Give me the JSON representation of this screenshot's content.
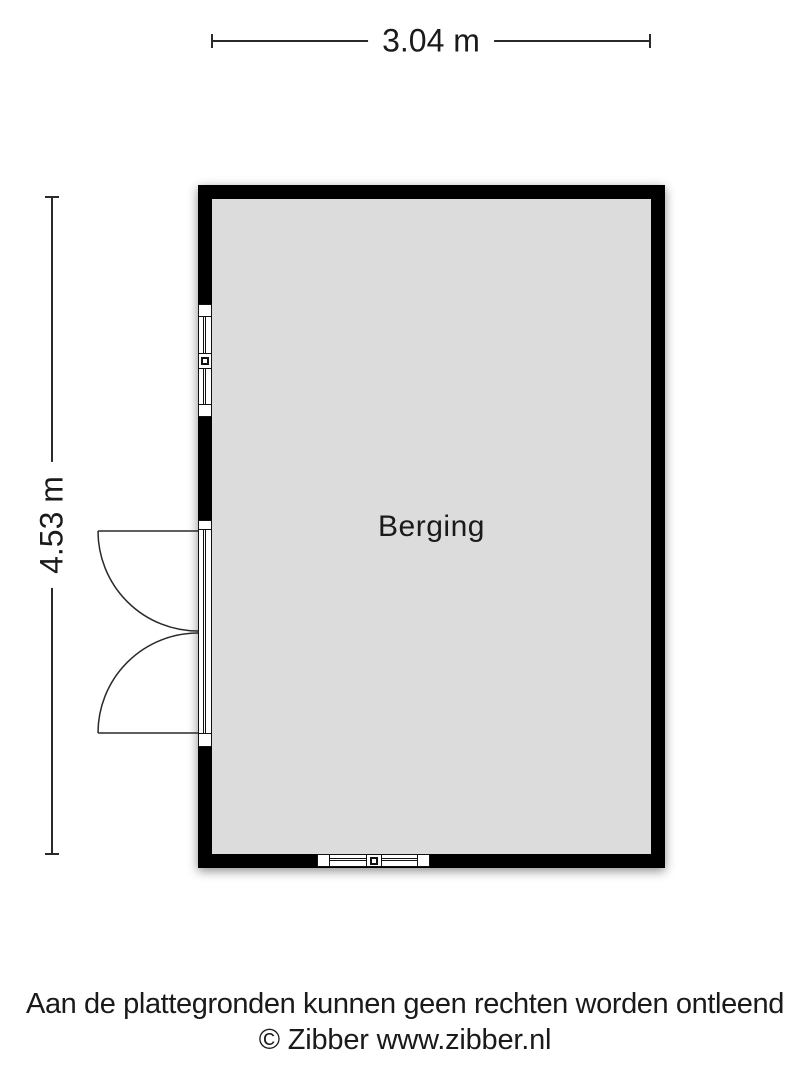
{
  "floorplan": {
    "room": {
      "label": "Berging"
    },
    "dimensions": {
      "width": "3.04 m",
      "height": "4.53 m"
    },
    "features": {
      "left_wall": [
        "window",
        "double-door-outward"
      ],
      "bottom_wall": [
        "window"
      ]
    },
    "colors": {
      "wall": "#000000",
      "floor": "#dcdcdc",
      "line": "#2a2a2a",
      "frame": "#111111"
    }
  },
  "footer": {
    "disclaimer": "Aan de plattegronden kunnen geen rechten worden ontleend",
    "copyright": "© Zibber www.zibber.nl"
  }
}
